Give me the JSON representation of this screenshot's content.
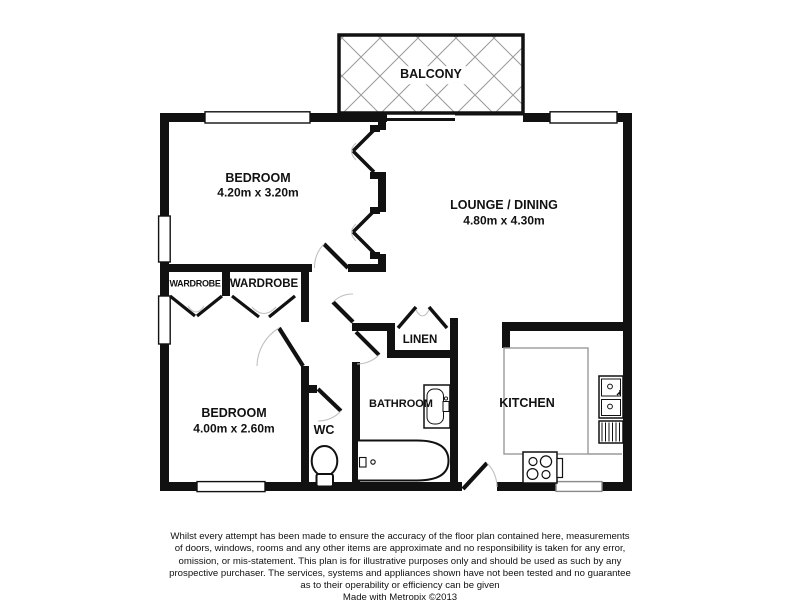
{
  "meta": {
    "disclaimer": "Whilst every attempt has been made to ensure the accuracy of the floor plan contained here, measurements of doors, windows, rooms and any other items are approximate and no responsibility is taken for any error, omission, or mis-statement. This plan is for illustrative purposes only and should be used as such by any prospective purchaser. The services, systems and appliances shown have not been tested and no guarantee as to their operability or efficiency can be given",
    "credit": "Made with Metropix ©2013"
  },
  "rooms": {
    "balcony": {
      "label": "BALCONY"
    },
    "bedroom1": {
      "label": "BEDROOM",
      "dims": "4.20m x 3.20m"
    },
    "lounge": {
      "label": "LOUNGE / DINING",
      "dims": "4.80m x 4.30m"
    },
    "wardrobe1": {
      "label": "WARDROBE"
    },
    "wardrobe2": {
      "label": "WARDROBE"
    },
    "bedroom2": {
      "label": "BEDROOM",
      "dims": "4.00m x 2.60m"
    },
    "wc": {
      "label": "WC"
    },
    "bathroom": {
      "label": "BATHROOM"
    },
    "linen": {
      "label": "LINEN"
    },
    "kitchen": {
      "label": "KITCHEN"
    }
  },
  "colors": {
    "wall": "#111111",
    "balcony_hatch": "#9a9a9a",
    "door_arc": "#c0c0c0",
    "counter_edge": "#999999",
    "background": "#ffffff"
  },
  "fixtures": [
    "toilet",
    "bathtub",
    "bathroom-sink",
    "kitchen-sink",
    "draining-board",
    "hob",
    "worktop",
    "entrance-door",
    "sliding-patio-door",
    "wardrobe-bifold-doors",
    "linen-double-doors"
  ]
}
